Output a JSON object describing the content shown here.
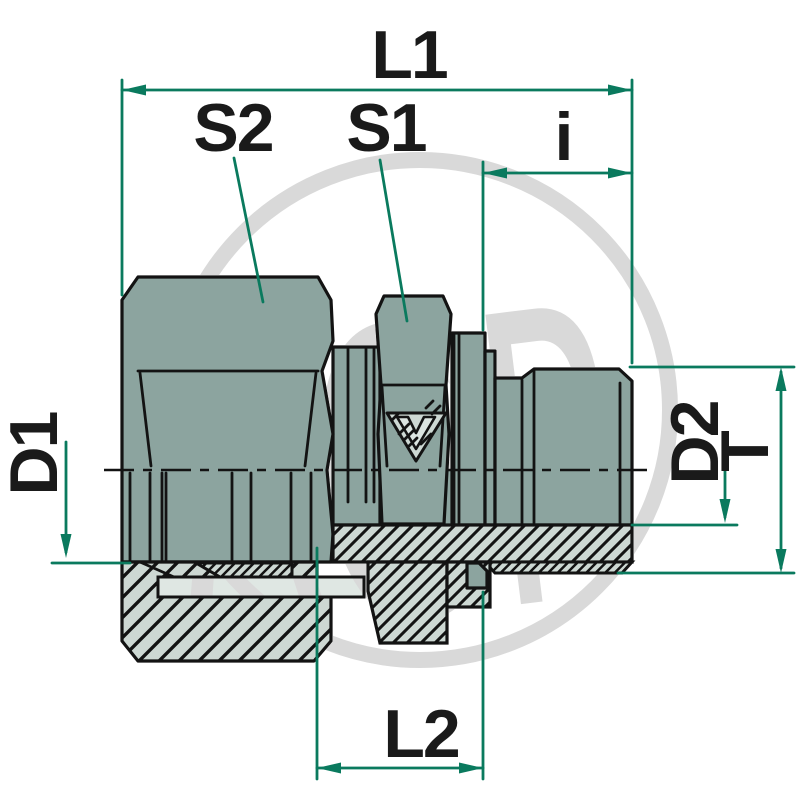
{
  "diagram": {
    "type": "technical-drawing-cross-section",
    "watermark_text": "AGP",
    "dimension_labels": {
      "l1": "L1",
      "s2": "S2",
      "s1": "S1",
      "i": "i",
      "d1": "D1",
      "d2": "D2",
      "t": "T",
      "l2": "L2"
    },
    "colors": {
      "body_fill": "#8CA49F",
      "section_fill": "#CDD8D3",
      "tube_fill": "#DFE7E3",
      "dimension_line": "#0A7A5E",
      "outline": "#131313",
      "watermark": "#D9D9D9",
      "background": "#FFFFFF"
    }
  }
}
